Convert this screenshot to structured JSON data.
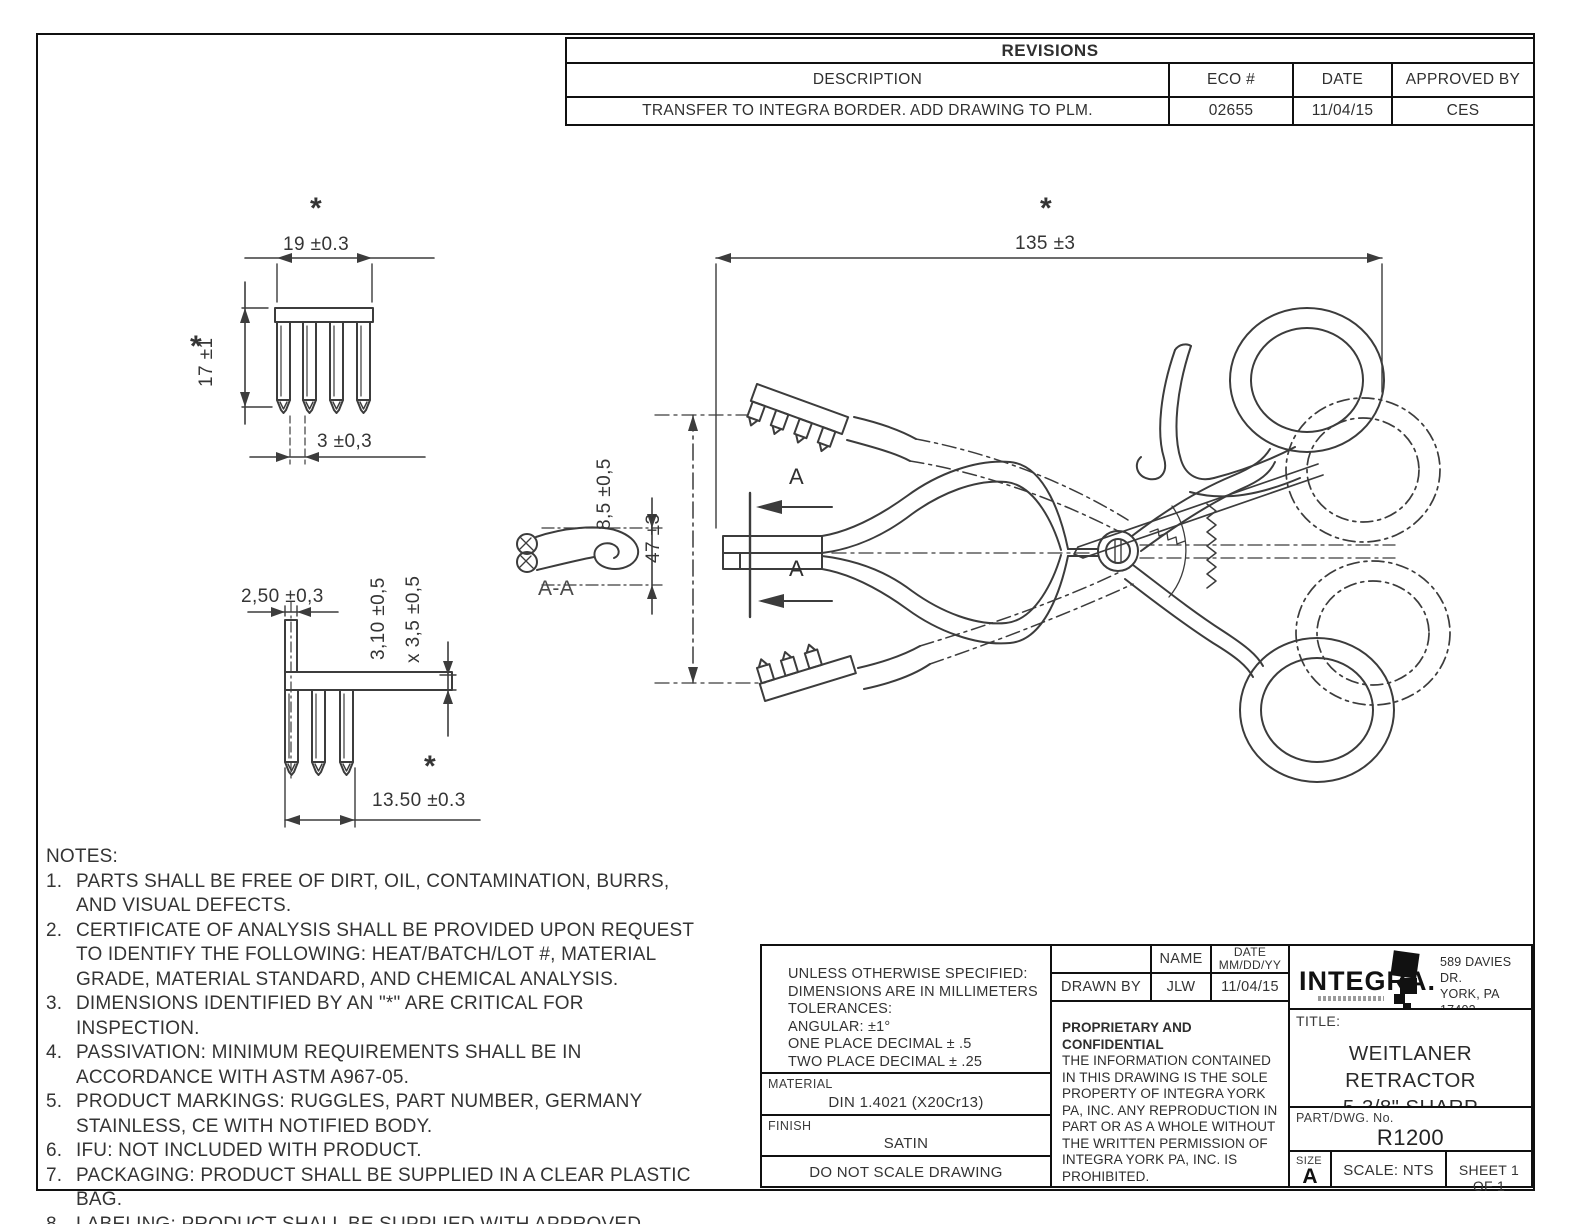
{
  "sheet": {
    "background": "#ffffff",
    "line_color": "#3c3c3c"
  },
  "revisions": {
    "title": "REVISIONS",
    "columns": {
      "description": "DESCRIPTION",
      "eco": "ECO #",
      "date": "DATE",
      "approved": "APPROVED BY"
    },
    "row": {
      "description": "TRANSFER TO INTEGRA BORDER. ADD DRAWING TO PLM.",
      "eco": "02655",
      "date": "11/04/15",
      "approved": "CES"
    }
  },
  "dimensions": {
    "asterisk": "*",
    "front_detail": {
      "width": "19 ±0.3",
      "height": "17 ±1",
      "pitch": "3 ±0,3"
    },
    "side_detail": {
      "prong_width": "2,50 ±0,3",
      "depth": "3,10 ±0,5",
      "depth2": "x 3,5 ±0,5",
      "span": "13.50 ±0.3"
    },
    "section": {
      "label": "A-A",
      "height": "8,5 ±0,5",
      "cut_label": "A"
    },
    "main": {
      "length": "135 ±3",
      "spread": "47 ±3"
    }
  },
  "notes": {
    "heading": "NOTES:",
    "items": [
      {
        "num": "1.",
        "text": "PARTS SHALL BE FREE OF DIRT, OIL, CONTAMINATION, BURRS, AND VISUAL DEFECTS."
      },
      {
        "num": "2.",
        "text": "CERTIFICATE OF ANALYSIS SHALL BE PROVIDED UPON REQUEST TO IDENTIFY THE FOLLOWING: HEAT/BATCH/LOT #, MATERIAL GRADE, MATERIAL STANDARD, AND CHEMICAL ANALYSIS."
      },
      {
        "num": "3.",
        "text": "DIMENSIONS IDENTIFIED BY AN \"*\" ARE CRITICAL FOR INSPECTION."
      },
      {
        "num": "4.",
        "text": "PASSIVATION: MINIMUM REQUIREMENTS SHALL BE IN ACCORDANCE WITH ASTM A967-05."
      },
      {
        "num": "5.",
        "text": "PRODUCT MARKINGS: RUGGLES, PART NUMBER, GERMANY STAINLESS, CE WITH NOTIFIED BODY."
      },
      {
        "num": "6.",
        "text": "IFU: NOT INCLUDED WITH PRODUCT."
      },
      {
        "num": "7.",
        "text": "PACKAGING: PRODUCT SHALL BE SUPPLIED IN A CLEAR PLASTIC BAG."
      },
      {
        "num": "8.",
        "text": "LABELING: PRODUCT SHALL BE SUPPLIED WITH APPROVED PRODUCT IDENTIFICATION LABEL(S)."
      }
    ]
  },
  "title_block": {
    "tolerances": {
      "line1": "UNLESS OTHERWISE SPECIFIED:",
      "line2": "DIMENSIONS ARE IN MILLIMETERS",
      "line3": "TOLERANCES:",
      "line4": "ANGULAR: ±1°",
      "line5": "ONE PLACE DECIMAL ± .5",
      "line6": "TWO PLACE DECIMAL ± .25"
    },
    "material": {
      "label": "MATERIAL",
      "value": "DIN 1.4021 (X20Cr13)"
    },
    "finish": {
      "label": "FINISH",
      "value": "SATIN"
    },
    "do_not_scale": "DO NOT SCALE DRAWING",
    "approvals": {
      "name_header": "NAME",
      "date_header": "DATE",
      "date_format": "MM/DD/YY",
      "drawn_by_label": "DRAWN BY",
      "drawn_by_name": "JLW",
      "drawn_by_date": "11/04/15"
    },
    "proprietary": {
      "heading": "PROPRIETARY AND CONFIDENTIAL",
      "body": "THE INFORMATION CONTAINED IN THIS DRAWING IS THE SOLE PROPERTY OF INTEGRA YORK PA, INC.  ANY REPRODUCTION IN PART OR AS A WHOLE WITHOUT THE WRITTEN PERMISSION OF INTEGRA YORK PA, INC. IS PROHIBITED."
    },
    "company": {
      "logo": "INTEGRA.",
      "address1": "589 DAVIES DR.",
      "address2": "YORK, PA 17402",
      "address3": "PHN. 1-800-645-8000"
    },
    "title": {
      "label": "TITLE:",
      "line1": "WEITLANER RETRACTOR",
      "line2": "5-3/8\" SHARP"
    },
    "part": {
      "label": "PART/DWG. No.",
      "value": "R1200"
    },
    "size": {
      "label": "SIZE",
      "value": "A"
    },
    "scale": "SCALE: NTS",
    "sheet": "SHEET 1 OF 1"
  }
}
